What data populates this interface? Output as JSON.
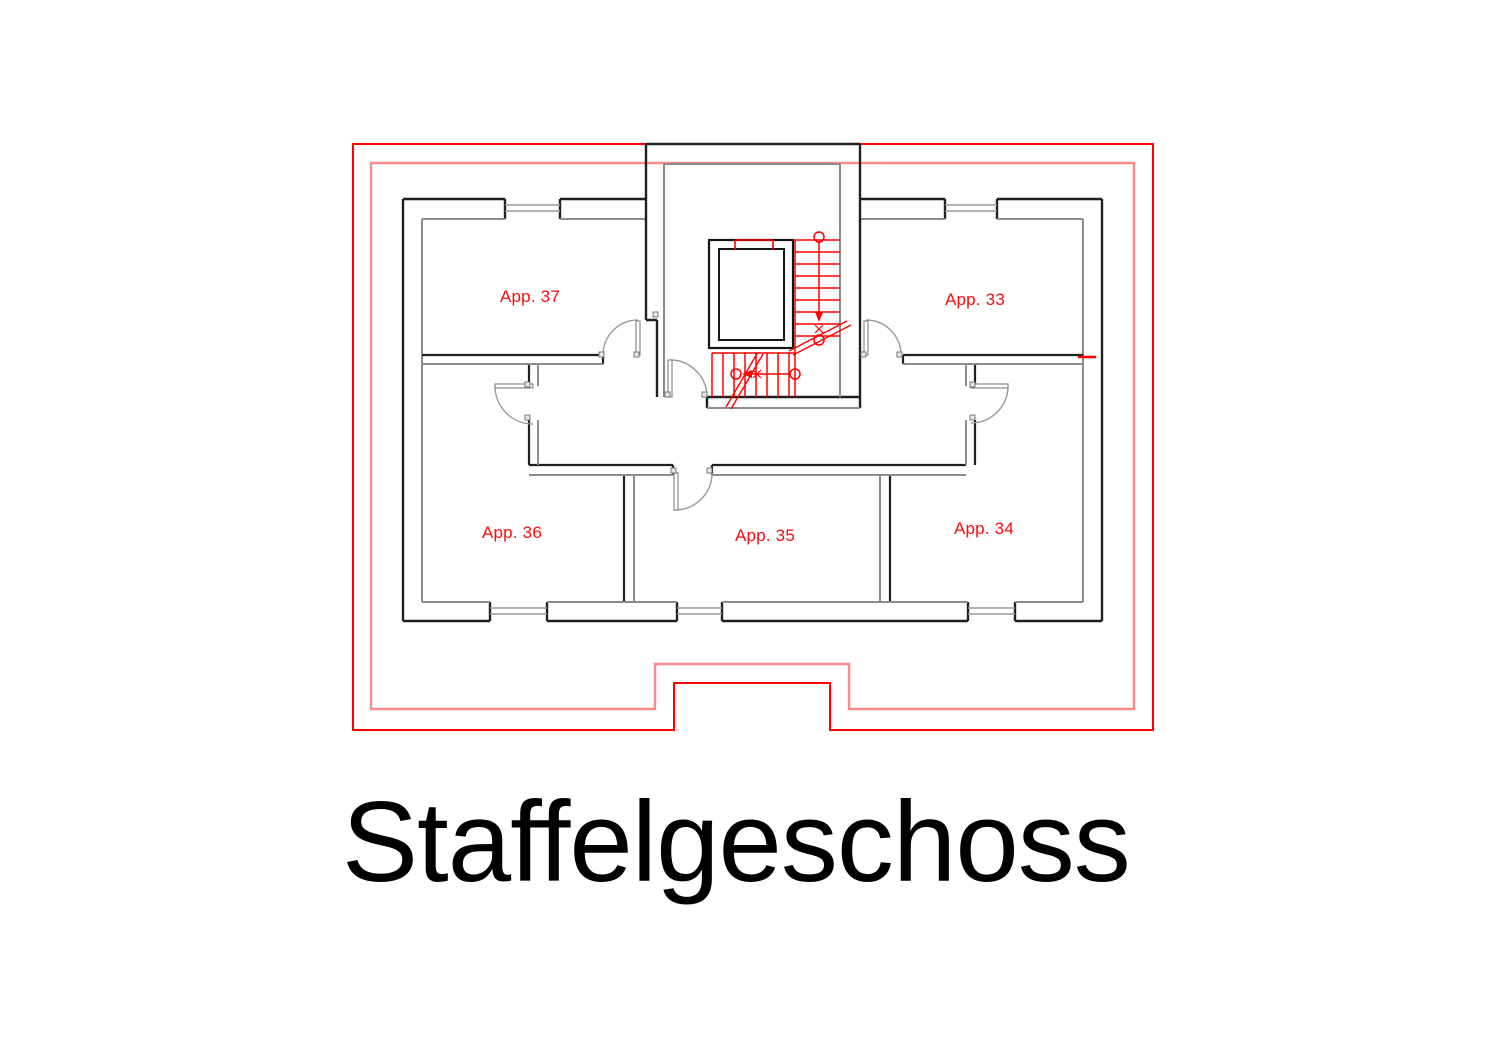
{
  "title": "Staffelgeschoss",
  "floor_plan": {
    "apartments": [
      {
        "id": "app-37",
        "label": "App. 37"
      },
      {
        "id": "app-33",
        "label": "App. 33"
      },
      {
        "id": "app-36",
        "label": "App. 36"
      },
      {
        "id": "app-35",
        "label": "App. 35"
      },
      {
        "id": "app-34",
        "label": "App. 34"
      }
    ],
    "colors": {
      "outline_red": "#ff0000",
      "outline_light_red": "#ff8a8a",
      "wall_dark": "#1f1f1f",
      "wall_gray": "#8c8c8c",
      "door_gray": "#999999",
      "label_red": "#f50f0f"
    }
  }
}
